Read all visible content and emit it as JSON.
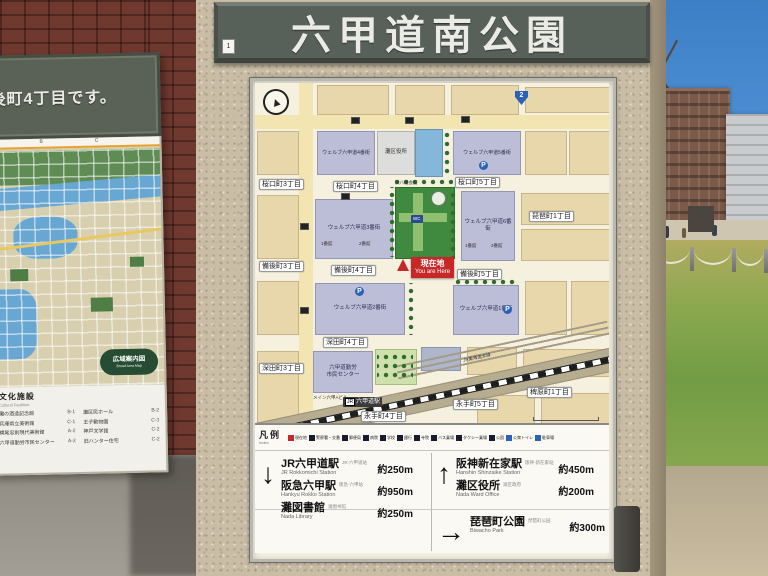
{
  "sign": {
    "title": "六甲道南公園",
    "plate": "1"
  },
  "left_sign": {
    "header": "備後町4丁目です。",
    "grid_letters": {
      "b": "B",
      "c": "C"
    },
    "badge_line1": "広域案内図",
    "badge_line2": "Broad Area Map",
    "section_title": "文化施設",
    "section_subtitle": "Cultural Facilities",
    "facilities": [
      {
        "name": "灘の酒造記念館",
        "ref": "B-1"
      },
      {
        "name": "兵庫県立美術館",
        "ref": "C-1"
      },
      {
        "name": "横尾忠則現代美術館",
        "ref": "A-2"
      },
      {
        "name": "六甲道勤労市民センター",
        "ref": "A-2"
      },
      {
        "name": "灘区民ホール",
        "ref": "B-2"
      },
      {
        "name": "王子動物園",
        "ref": "C-3"
      },
      {
        "name": "神戸文学館",
        "ref": "C-2"
      },
      {
        "name": "旧ハンター住宅",
        "ref": "C-2"
      }
    ],
    "legend_colors": [
      "#1a1a3a",
      "#2a62b8",
      "#1a1a3a",
      "#777777",
      "#2a62b8",
      "#1a1a3a",
      "#8a1a1a",
      "#1a1a3a",
      "#2a62b8",
      "#555555"
    ]
  },
  "map": {
    "you_are_here_ja": "現在地",
    "you_are_here_en": "You are Here",
    "station_jr": "JR",
    "station": "六甲道駅",
    "blocks": [
      {
        "x": 62,
        "y": 2,
        "w": 70,
        "h": 28,
        "c": "tan"
      },
      {
        "x": 140,
        "y": 2,
        "w": 48,
        "h": 28,
        "c": "tan"
      },
      {
        "x": 196,
        "y": 2,
        "w": 66,
        "h": 28,
        "c": "tan"
      },
      {
        "x": 270,
        "y": 4,
        "w": 84,
        "h": 24,
        "c": "tan"
      },
      {
        "x": 2,
        "y": 48,
        "w": 40,
        "h": 42,
        "c": "tan"
      },
      {
        "x": 270,
        "y": 48,
        "w": 40,
        "h": 42,
        "c": "tan"
      },
      {
        "x": 314,
        "y": 48,
        "w": 40,
        "h": 42,
        "c": "tan"
      },
      {
        "x": 2,
        "y": 112,
        "w": 40,
        "h": 62,
        "c": "tan"
      },
      {
        "x": 266,
        "y": 110,
        "w": 88,
        "h": 30,
        "c": "tan"
      },
      {
        "x": 266,
        "y": 146,
        "w": 88,
        "h": 30,
        "c": "tan"
      },
      {
        "x": 2,
        "y": 198,
        "w": 40,
        "h": 52,
        "c": "tan"
      },
      {
        "x": 270,
        "y": 198,
        "w": 40,
        "h": 52,
        "c": "tan"
      },
      {
        "x": 316,
        "y": 198,
        "w": 38,
        "h": 52,
        "c": "tan"
      },
      {
        "x": 2,
        "y": 268,
        "w": 40,
        "h": 70,
        "c": "tan"
      },
      {
        "x": 212,
        "y": 264,
        "w": 48,
        "h": 26,
        "c": "tan"
      },
      {
        "x": 268,
        "y": 266,
        "w": 86,
        "h": 26,
        "c": "tan"
      },
      {
        "x": 222,
        "y": 312,
        "w": 56,
        "h": 28,
        "c": "tan"
      },
      {
        "x": 286,
        "y": 310,
        "w": 68,
        "h": 30,
        "c": "tan"
      },
      {
        "t": "ウェルブ六甲道4番街",
        "x": 62,
        "y": 48,
        "w": 56,
        "h": 42,
        "c": "purple",
        "fs": 5
      },
      {
        "t": "灘区役所",
        "x": 122,
        "y": 48,
        "w": 36,
        "h": 42,
        "c": "gray",
        "fs": 5.5
      },
      {
        "x": 160,
        "y": 46,
        "w": 26,
        "h": 46,
        "c": "blue"
      },
      {
        "t": "ウェルブ六甲道5番街",
        "x": 198,
        "y": 48,
        "w": 66,
        "h": 42,
        "c": "purple",
        "fs": 5
      },
      {
        "t": "ウェルブ六甲道3番街",
        "x": 60,
        "y": 116,
        "w": 76,
        "h": 58,
        "c": "purple",
        "fs": 5.5
      },
      {
        "x": 140,
        "y": 104,
        "w": 58,
        "h": 70,
        "c": "park"
      },
      {
        "x": 158,
        "y": 110,
        "w": 10,
        "h": 58,
        "c": "parkpath"
      },
      {
        "x": 144,
        "y": 130,
        "w": 48,
        "h": 9,
        "c": "parkpath"
      },
      {
        "t": "ウェルブ六甲道6番街",
        "x": 206,
        "y": 108,
        "w": 52,
        "h": 68,
        "c": "purple",
        "fs": 5.5
      },
      {
        "t": "ウェルブ六甲道2番街",
        "x": 60,
        "y": 200,
        "w": 88,
        "h": 50,
        "c": "purple",
        "fs": 5.5
      },
      {
        "t": "ウェルブ六甲道1番街",
        "x": 198,
        "y": 202,
        "w": 64,
        "h": 48,
        "c": "purple",
        "fs": 5.5
      },
      {
        "t": "六甲道勤労\n市民センター",
        "x": 58,
        "y": 268,
        "w": 58,
        "h": 40,
        "c": "purple",
        "fs": 5.5
      },
      {
        "x": 120,
        "y": 266,
        "w": 40,
        "h": 34,
        "c": "lightpark"
      },
      {
        "x": 166,
        "y": 264,
        "w": 38,
        "h": 22,
        "c": "bluegray"
      }
    ],
    "chips": [
      {
        "t": "桜口町3丁目",
        "x": 4,
        "y": 96
      },
      {
        "t": "桜口町4丁目",
        "x": 78,
        "y": 98
      },
      {
        "t": "桜口町5丁目",
        "x": 200,
        "y": 94
      },
      {
        "t": "琵琶町1丁目",
        "x": 274,
        "y": 128
      },
      {
        "t": "備後町3丁目",
        "x": 4,
        "y": 178
      },
      {
        "t": "備後町4丁目",
        "x": 76,
        "y": 182
      },
      {
        "t": "備後町5丁目",
        "x": 202,
        "y": 186
      },
      {
        "t": "深田町4丁目",
        "x": 68,
        "y": 254
      },
      {
        "t": "深田町3丁目",
        "x": 4,
        "y": 280
      },
      {
        "t": "永手町4丁目",
        "x": 106,
        "y": 328
      },
      {
        "t": "永手町5丁目",
        "x": 198,
        "y": 316
      },
      {
        "t": "稗原町1丁目",
        "x": 272,
        "y": 304
      }
    ],
    "labels": [
      {
        "t": "浜八幡会館",
        "x": 140,
        "y": 97
      },
      {
        "t": "1番館",
        "x": 66,
        "y": 158
      },
      {
        "t": "2番館",
        "x": 104,
        "y": 158
      },
      {
        "t": "1番館",
        "x": 210,
        "y": 160
      },
      {
        "t": "2番館",
        "x": 236,
        "y": 160
      },
      {
        "t": "メイン六甲Aビル",
        "x": 58,
        "y": 312
      },
      {
        "t": "JR東海道本線",
        "x": 208,
        "y": 272,
        "rot": -12
      }
    ],
    "icons": [
      {
        "t": "P",
        "x": 224,
        "y": 78,
        "c": "p"
      },
      {
        "t": "P",
        "x": 100,
        "y": 204,
        "c": "p"
      },
      {
        "t": "P",
        "x": 248,
        "y": 222,
        "c": "p"
      },
      {
        "t": "WC",
        "x": 156,
        "y": 132,
        "c": "wc"
      },
      {
        "t": "2",
        "x": 260,
        "y": 8,
        "c": "shield"
      },
      {
        "x": 96,
        "y": 34,
        "c": "sq"
      },
      {
        "x": 150,
        "y": 34,
        "c": "sq"
      },
      {
        "x": 206,
        "y": 33,
        "c": "sq"
      },
      {
        "x": 86,
        "y": 110,
        "c": "sq"
      },
      {
        "x": 45,
        "y": 140,
        "c": "sq"
      },
      {
        "x": 45,
        "y": 224,
        "c": "sq"
      },
      {
        "x": 176,
        "y": 108,
        "c": "fountain"
      }
    ],
    "trees": [
      {
        "x": 188,
        "y": 48,
        "w": 8,
        "h": 44
      },
      {
        "x": 140,
        "y": 95,
        "w": 58,
        "h": 8
      },
      {
        "x": 194,
        "y": 104,
        "w": 8,
        "h": 70
      },
      {
        "x": 133,
        "y": 104,
        "w": 8,
        "h": 70
      },
      {
        "x": 152,
        "y": 200,
        "w": 8,
        "h": 52
      },
      {
        "x": 198,
        "y": 195,
        "w": 64,
        "h": 8
      },
      {
        "x": 122,
        "y": 268,
        "w": 36,
        "h": 30
      }
    ]
  },
  "legend": {
    "title": "凡例",
    "subtitle": "Index",
    "items": [
      {
        "t": "現在地",
        "color": "#c62828"
      },
      {
        "t": "警察署・交番",
        "color": "#1a1a2e"
      },
      {
        "t": "郵便局",
        "color": "#1a1a2e"
      },
      {
        "t": "病院",
        "color": "#1a1a2e"
      },
      {
        "t": "学校",
        "color": "#1a1a2e"
      },
      {
        "t": "銀行",
        "color": "#1a1a2e"
      },
      {
        "t": "寺院",
        "color": "#1a1a2e"
      },
      {
        "t": "バス乗場",
        "color": "#1a1a2e"
      },
      {
        "t": "タクシー乗場",
        "color": "#1a1a2e"
      },
      {
        "t": "公園",
        "color": "#1a1a2e"
      },
      {
        "t": "公衆トイレ",
        "color": "#2a62b8"
      },
      {
        "t": "駐車場",
        "color": "#2a62b8"
      }
    ]
  },
  "directions": {
    "left": {
      "arrow": "↓",
      "entries": [
        {
          "ja": "JR六甲道駅",
          "en": "JR Rokkomichi Station",
          "note": "JR·六甲道站",
          "dist": "約250m"
        },
        {
          "ja": "阪急六甲駅",
          "en": "Hankyu Rokko Station",
          "note": "阪急·六甲站",
          "dist": "約950m"
        },
        {
          "ja": "灘図書館",
          "en": "Nada Library",
          "note": "滩图书馆",
          "dist": "約250m"
        }
      ]
    },
    "right_top": {
      "arrow": "↑",
      "entries": [
        {
          "ja": "阪神新在家駅",
          "en": "Hanshin Shinzaike Station",
          "note": "阪神·新在家站",
          "dist": "約450m"
        },
        {
          "ja": "灘区役所",
          "en": "Nada Ward Office",
          "note": "滩区政府",
          "dist": "約200m"
        }
      ]
    },
    "right_bottom": {
      "arrow": "→",
      "entries": [
        {
          "ja": "琵琶町公園",
          "en": "Biwacho Park",
          "note": "琵琶町公园",
          "dist": "約300m"
        }
      ]
    }
  }
}
